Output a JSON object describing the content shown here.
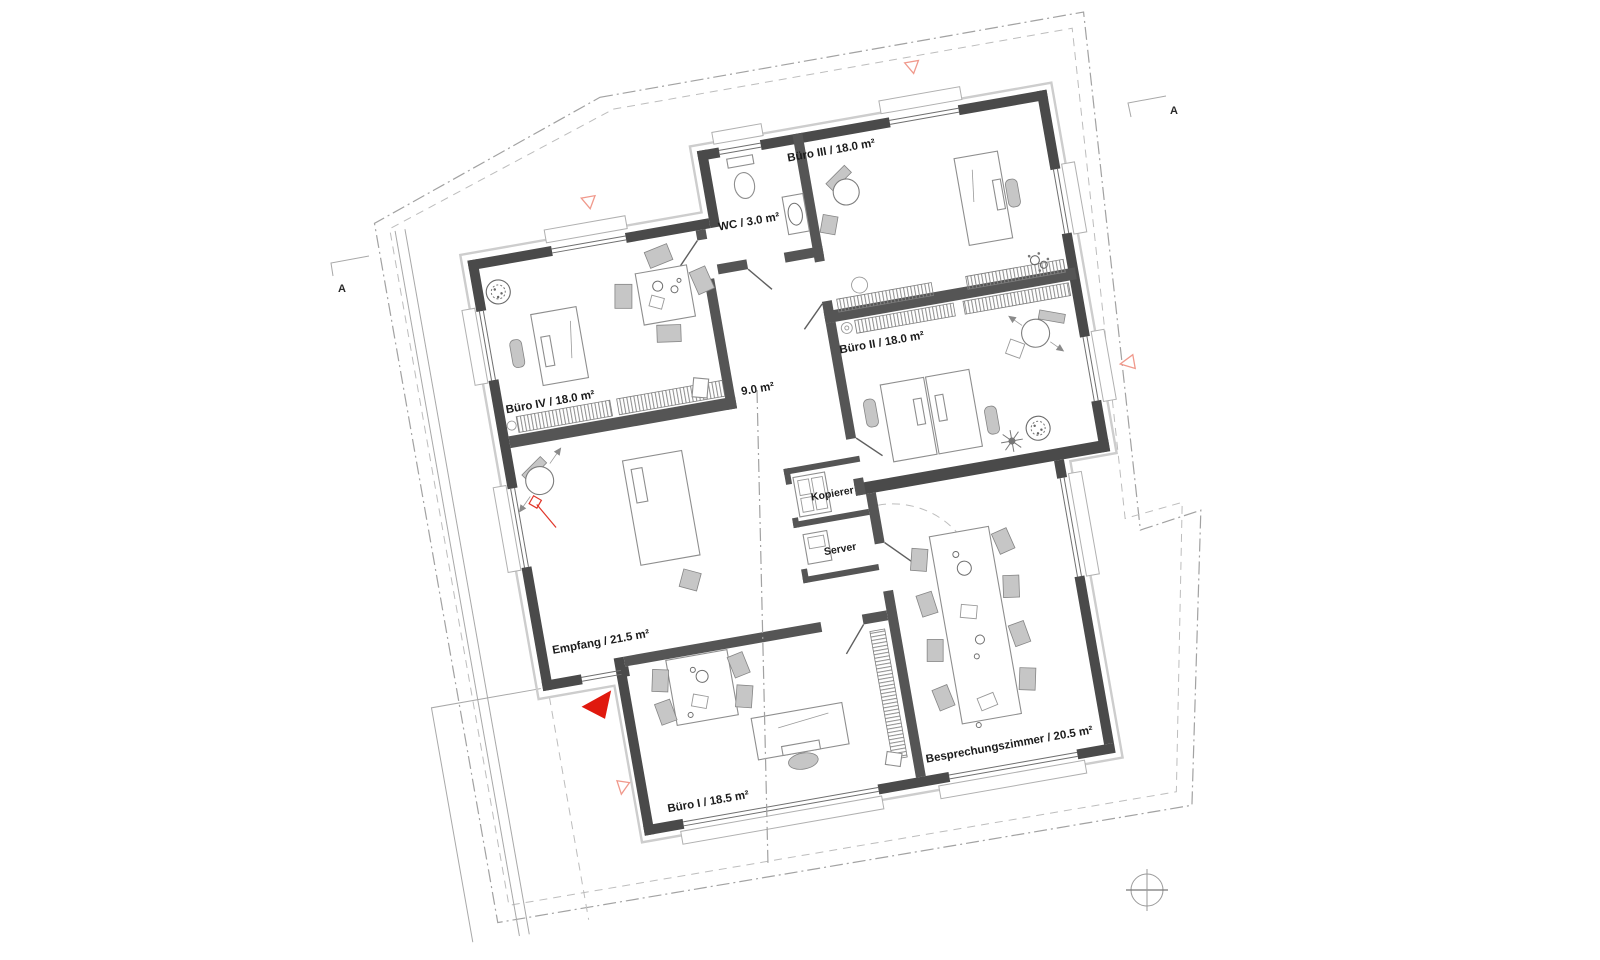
{
  "plan": {
    "type": "architectural-floor-plan",
    "rooms": [
      {
        "id": "buero3",
        "label": "Büro III / 18.0 m²"
      },
      {
        "id": "wc",
        "label": "WC / 3.0 m²"
      },
      {
        "id": "buero2",
        "label": "Büro II / 18.0 m²"
      },
      {
        "id": "buero4",
        "label": "Büro IV / 18.0 m²"
      },
      {
        "id": "flur",
        "label": "9.0 m²"
      },
      {
        "id": "kopierer",
        "label": "Kopierer"
      },
      {
        "id": "server",
        "label": "Server"
      },
      {
        "id": "empfang",
        "label": "Empfang / 21.5 m²"
      },
      {
        "id": "buero1",
        "label": "Büro I / 18.5 m²"
      },
      {
        "id": "besprechung",
        "label": "Besprechungszimmer / 20.5 m²"
      }
    ],
    "section_markers": [
      {
        "label": "A",
        "position": "left"
      },
      {
        "label": "A",
        "position": "top-right"
      }
    ],
    "colors": {
      "wall": "#4a4a4a",
      "red_accent": "#e0190e",
      "red_light": "#f0998c",
      "roof_line": "#a2a2a2"
    }
  }
}
